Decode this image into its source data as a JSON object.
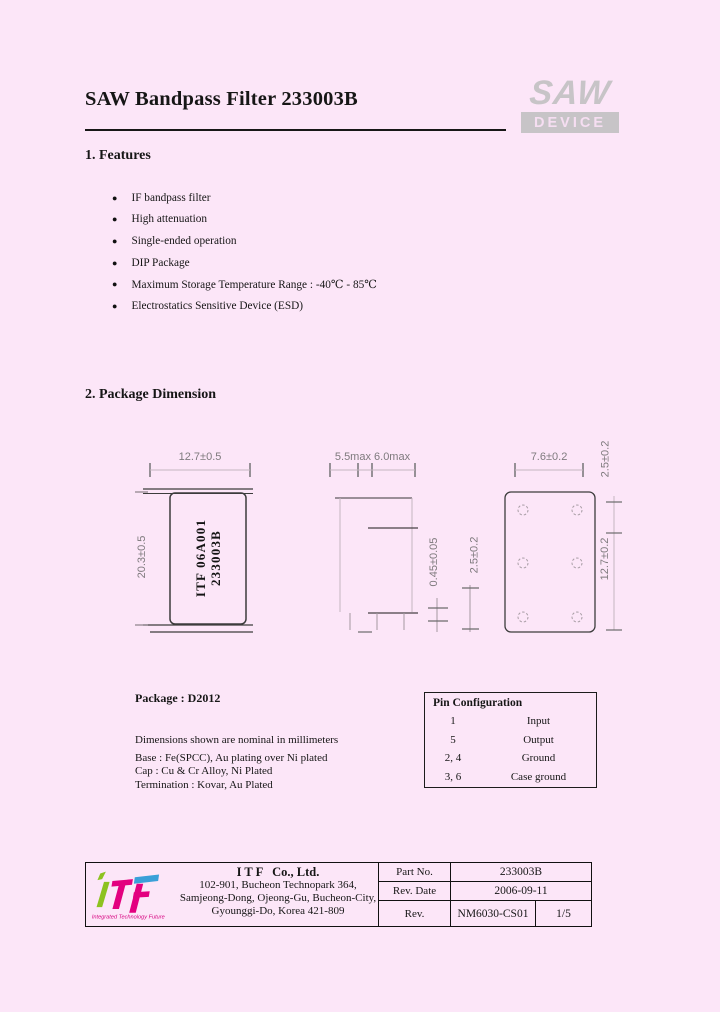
{
  "header": {
    "title": "SAW Bandpass Filter 233003B",
    "logo": {
      "saw": "SAW",
      "device": "DEVICE"
    }
  },
  "features": {
    "heading": "1. Features",
    "items": [
      "IF bandpass filter",
      "High attenuation",
      "Single-ended operation",
      "DIP Package",
      "Maximum Storage Temperature Range : -40℃ - 85℃",
      "Electrostatics Sensitive Device (ESD)"
    ]
  },
  "package_dimension": {
    "heading": "2. Package Dimension",
    "front_view": {
      "top_dim": "12.7±0.5",
      "side_dim": "20.3±0.5",
      "marking": [
        "ITF 06A001",
        "233003B"
      ]
    },
    "side_view": {
      "top_dim": "5.5max 6.0max",
      "thickness_dim": "0.45±0.05",
      "lead_dim": "2.5±0.2"
    },
    "bottom_view": {
      "top_dim": "7.6±0.2",
      "pitch_dim": "2.5±0.2",
      "side_dim": "12.7±0.2"
    },
    "package_label": "Package : D2012",
    "notes": [
      "Dimensions shown are nominal in millimeters",
      "Base : Fe(SPCC), Au plating over Ni plated",
      "Cap : Cu & Cr Alloy, Ni Plated",
      "Termination : Kovar, Au Plated"
    ]
  },
  "pin_configuration": {
    "heading": "Pin Configuration",
    "rows": [
      {
        "pin": "1",
        "function": "Input"
      },
      {
        "pin": "5",
        "function": "Output"
      },
      {
        "pin": "2, 4",
        "function": "Ground"
      },
      {
        "pin": "3, 6",
        "function": "Case ground"
      }
    ]
  },
  "footer": {
    "logo_tagline": "Integrated Technology Future",
    "company": "I T F   Co., Ltd.",
    "address_lines": [
      "102-901, Bucheon Technopark 364,",
      "Samjeong-Dong, Ojeong-Gu, Bucheon-City,",
      "Gyounggi-Do, Korea 421-809"
    ],
    "fields": {
      "part_no_label": "Part No.",
      "part_no": "233003B",
      "rev_date_label": "Rev. Date",
      "rev_date": "2006-09-11",
      "rev_label": "Rev.",
      "rev": "NM6030-CS01",
      "page": "1/5"
    }
  },
  "colors": {
    "page_background": "#fce6f8",
    "saw_logo_gray": "#c7c4c7",
    "itf_green": "#8dc21f",
    "itf_magenta": "#e3007f",
    "itf_blue": "#3aa0d8"
  }
}
